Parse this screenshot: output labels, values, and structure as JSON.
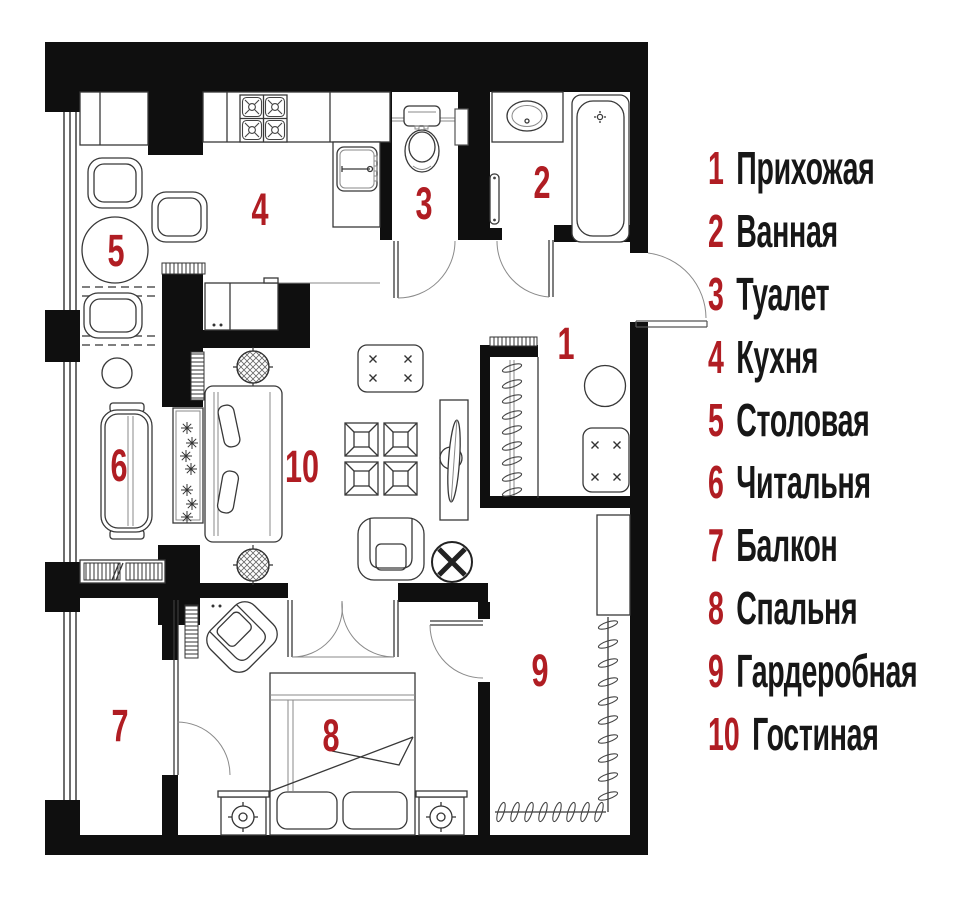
{
  "colors": {
    "accent": "#b01d23",
    "wall": "#0f0f0f"
  },
  "legend": {
    "items": [
      {
        "number": "1",
        "label": "Прихожая"
      },
      {
        "number": "2",
        "label": "Ванная"
      },
      {
        "number": "3",
        "label": "Туалет"
      },
      {
        "number": "4",
        "label": "Кухня"
      },
      {
        "number": "5",
        "label": "Столовая"
      },
      {
        "number": "6",
        "label": "Читальня"
      },
      {
        "number": "7",
        "label": "Балкон"
      },
      {
        "number": "8",
        "label": "Спальня"
      },
      {
        "number": "9",
        "label": "Гардеробная"
      },
      {
        "number": "10",
        "label": "Гостиная"
      }
    ]
  },
  "plan": {
    "numbers": [
      "1",
      "2",
      "3",
      "4",
      "5",
      "6",
      "7",
      "8",
      "9",
      "10"
    ],
    "rooms": [
      {
        "number": "1",
        "name": "hallway"
      },
      {
        "number": "2",
        "name": "bathroom"
      },
      {
        "number": "3",
        "name": "toilet"
      },
      {
        "number": "4",
        "name": "kitchen"
      },
      {
        "number": "5",
        "name": "dining-room"
      },
      {
        "number": "6",
        "name": "reading-room"
      },
      {
        "number": "7",
        "name": "balcony"
      },
      {
        "number": "8",
        "name": "bedroom"
      },
      {
        "number": "9",
        "name": "walk-in-closet"
      },
      {
        "number": "10",
        "name": "living-room"
      }
    ]
  }
}
